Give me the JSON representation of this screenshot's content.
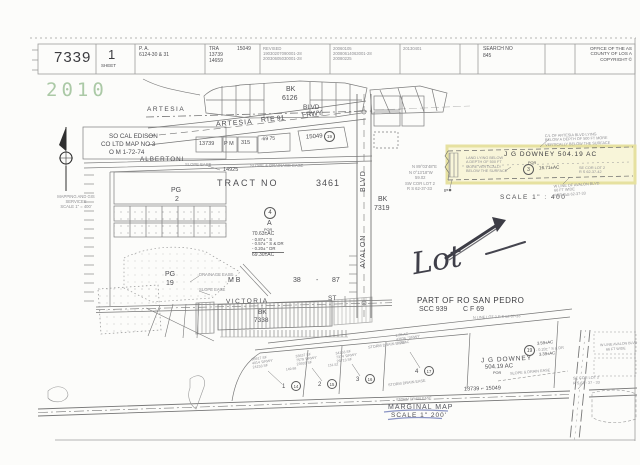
{
  "header": {
    "book": "7339",
    "sheet_number": "1",
    "sheet_label": "SHEET",
    "pa_label": "P. A.",
    "pa_value": "6124-30 & 31",
    "tra_label": "TRA",
    "tra_values": [
      "15049",
      "13739",
      "14659"
    ],
    "revised_label": "REVISED",
    "revised_values": [
      "19030207090001-28",
      "20030605030001-28"
    ],
    "revision_dates": [
      "20060105",
      "20080614063001-28",
      "20080225"
    ],
    "revision_date2": "20130401",
    "search_label": "SEARCH NO",
    "search_value": "845",
    "office_lines": [
      "OFFICE OF THE AS",
      "COUNTY OF LOS A",
      "COPYRIGHT ©"
    ]
  },
  "stamp": {
    "year": "2010",
    "color": "#a3c49e"
  },
  "compass_note": [
    "MAPPING AND GIS",
    "SERVICES",
    "SCALE 1\" = 400'"
  ],
  "top_map": {
    "bk": "BK",
    "bk_no": "6126",
    "artesia": "ARTESIA",
    "blvd": "BLVD",
    "frwy_artesia": "ARTESIA",
    "frwy_rte": "RTE 91",
    "frwy": "FRWY",
    "pm_13739": "13739",
    "pm": "P M",
    "pm_315": "315",
    "pm_69_75": "-69  75",
    "pm_15049": "15049",
    "pm_circle": "19",
    "edison_1": "SO CAL EDISON",
    "edison_2": "CO  LTD MAP  NO  3",
    "edison_3": "O M  1-72-74",
    "albertoni": "ALBERTONI"
  },
  "tract": {
    "w1": "TRACT",
    "w2": "NO",
    "w3": "3461",
    "n14925": "14925",
    "slope_ease": "SLOPE EASE",
    "slope_drainage": "SLOPE & DRAINAGE EASE",
    "pg2_l1": "PG",
    "pg2_l2": "2",
    "pg19_l1": "PG",
    "pg19_l2": "19",
    "drainage_ease": "DRAINAGE EASE",
    "slope_ease2": "SLOPE  EASE",
    "mb": "M B",
    "mb_38": "38",
    "mb_dash": "-",
    "mb_87": "87",
    "parcel_circle": "4",
    "parcel_letter": "A",
    "parcel_por": "POR",
    "areas": [
      "70.63±AC",
      "- 0.87±  \" S",
      "- 0.57±  \" S & DR",
      "- 0.20±  \" DR",
      "69.30±AC"
    ]
  },
  "avalon": {
    "name": "AVALON",
    "blvd": "BLVD",
    "bk": "BK",
    "bk_no": "7319",
    "notes": [
      "N 89°03'48\"E",
      "N 0°13'18\"W",
      "59.02",
      "SW COR LOT 2",
      "R S  62-37-33"
    ]
  },
  "inset": {
    "title": "J G DOWNEY   504.19 AC",
    "por": "POR",
    "circle": "3",
    "area": "16.71±AC",
    "callout_top": [
      "C/L OF ARTESIA BLVD LYING",
      "BELOW A DEPTH OF 500 FT MORE",
      "VERTICALLY BELOW THE SURFACE"
    ],
    "callout_left": [
      "LAND LYING BELOW",
      "A DEPTH OF 500 FT",
      "MORE VERTICALLY",
      "BELOW THE SURFACE"
    ],
    "se_cor": [
      "SE COR LOT 2",
      "R S 62-37-42"
    ],
    "w_line": [
      "W LINE OF AVALON BLVD",
      "66 FT WIDE",
      "PER R S 62-37-33"
    ],
    "scale": "SCALE  1\" : 400'",
    "ip": "IP"
  },
  "annotation": {
    "word": "Lot"
  },
  "victoria": {
    "name": "VICTORIA",
    "st": "ST",
    "bk": "BK",
    "bk_no": "7338"
  },
  "san_pedro": {
    "title": "PART OF RO SAN PEDRO",
    "scc": "SCC   939",
    "cf": "C F   69",
    "note": "N LINE LOT 2   R S 62-37-33"
  },
  "marginal": {
    "downey_1": "J G  DOWNEY",
    "downey_2": "504.19 AC",
    "downey_3": "POR",
    "circle19": "19",
    "area_1": "3.59±AC",
    "area_2": "- 0.20±  \" S & DR",
    "area_3": "3.39±AC",
    "slope_drain": "SLOPE & DRAIN EASE",
    "storm_a": "STORM DRAIN EASE",
    "storm_b": "STORM DRAIN EASE",
    "storm_c": "STORM DRAIN EASE",
    "p1": "1",
    "c1": "14",
    "p2": "2",
    "c2": "15",
    "p3": "3",
    "c3": "16",
    "p4": "4",
    "c4": "17",
    "sf1": [
      "36917 SF",
      "4014  'DRWY'",
      "24153 SF"
    ],
    "sf2": [
      "33637 SF",
      "7579  'DRWY'",
      "23933 SF"
    ],
    "sf3": [
      "34153 SF",
      "7374  'DRWY'",
      "26713 SF"
    ],
    "sf4": [
      "1.35 AC",
      "43636 ' DRWY'",
      "7.25 AC"
    ],
    "dim1": "149.98",
    "dim2": "151.52",
    "pm_row": "13739  ⌐  15049",
    "se_cor_1": "SE COR LOT 2",
    "se_cor_2": "R S  62 - 37 - 33",
    "w_line_1": "W LINE AVALON BLVD",
    "w_line_2": "66 FT WIDE",
    "title": "MARGINAL MAP",
    "scale": "SCALE  1\" 200'"
  }
}
